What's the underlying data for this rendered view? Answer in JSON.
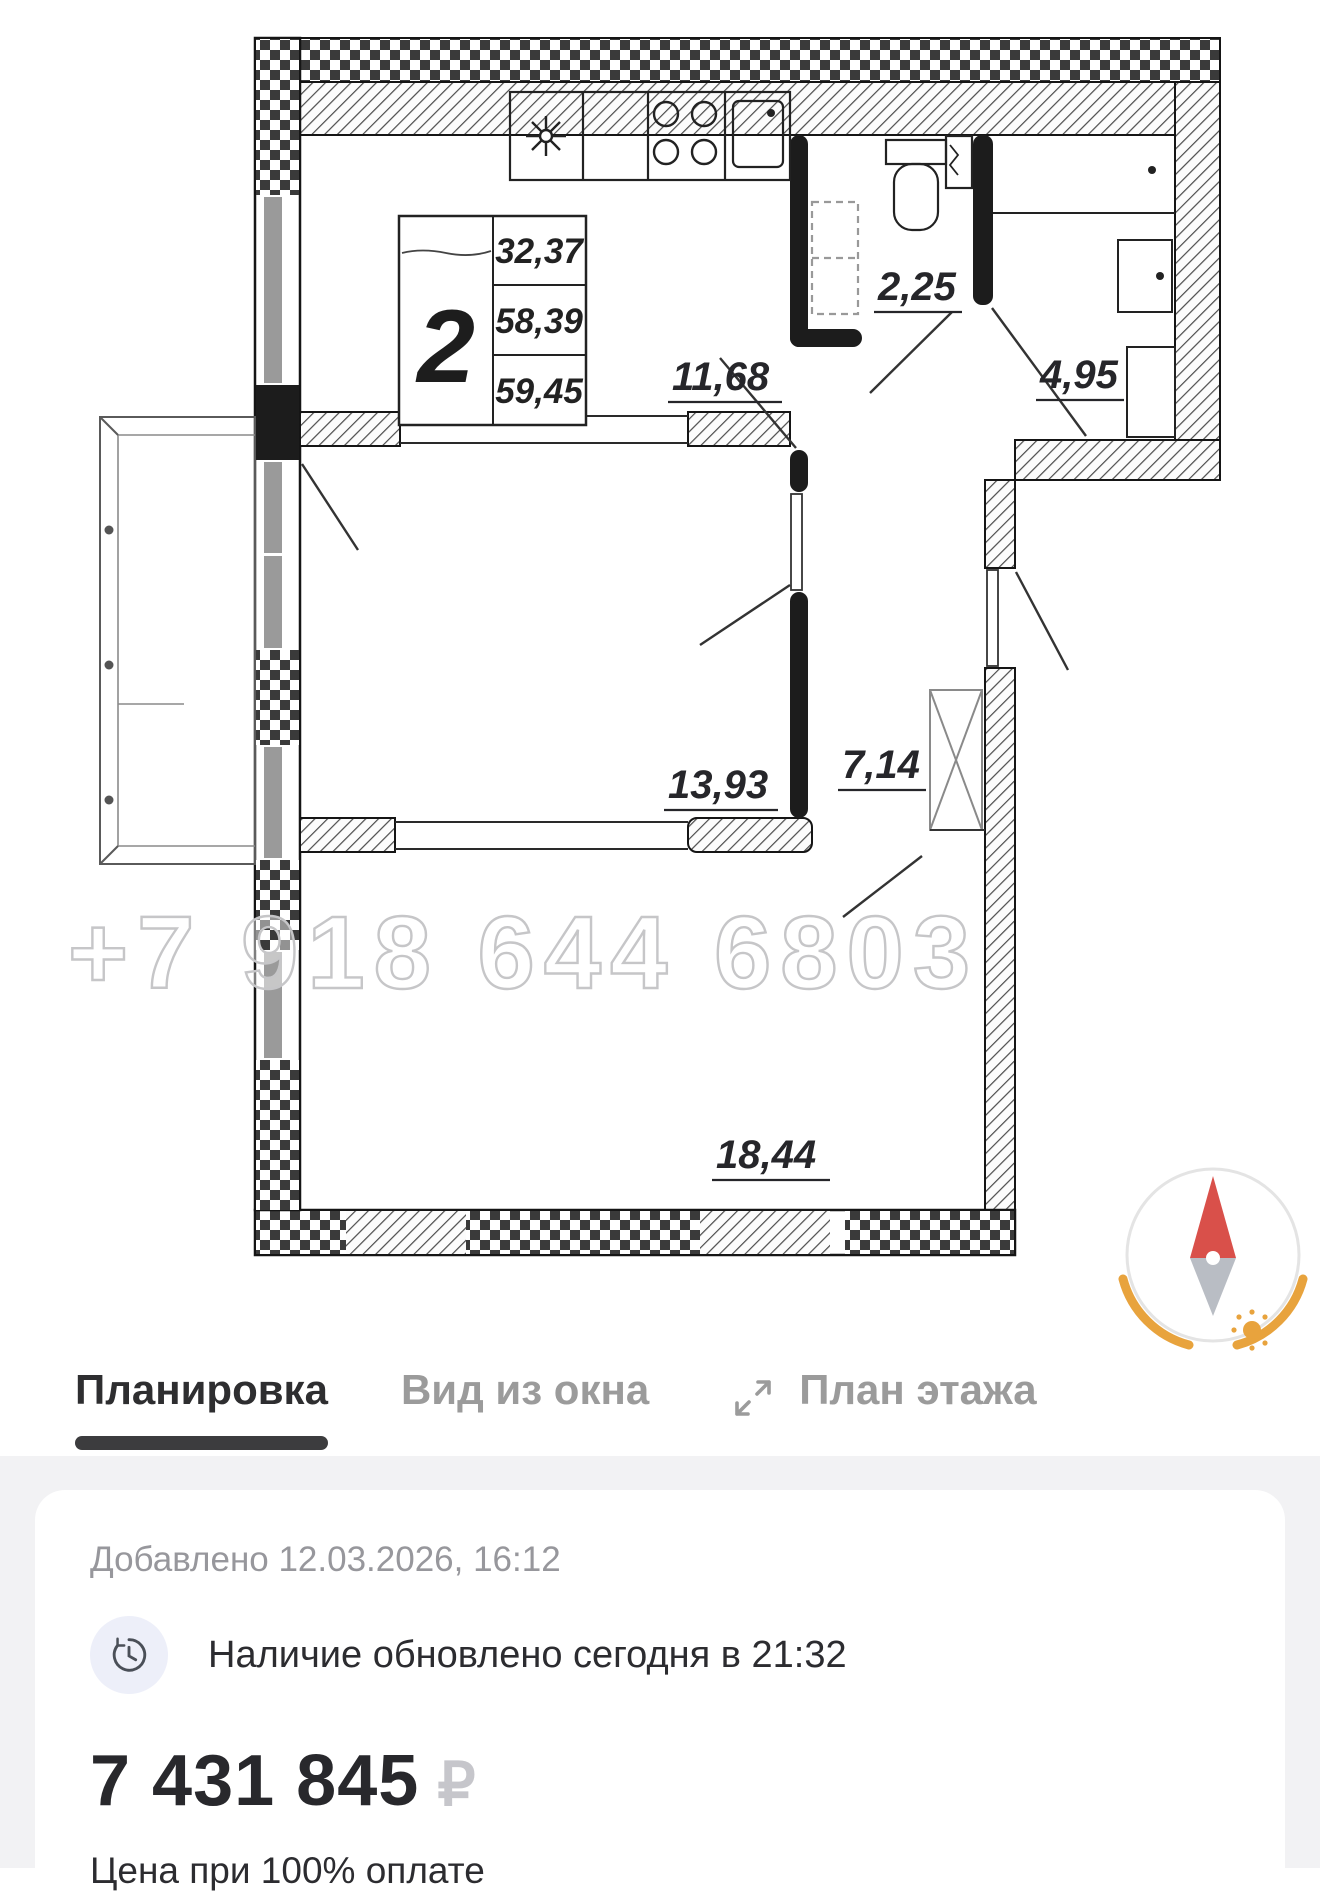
{
  "plan": {
    "watermark": "+7 918 644 6803",
    "unit_table": {
      "rooms": "2",
      "area_living": "32,37",
      "area_total": "58,39",
      "area_with_balcony": "59,45"
    },
    "labels": {
      "kitchen": "11,68",
      "wc": "2,25",
      "bathroom": "4,95",
      "bedroom": "13,93",
      "hall": "7,14",
      "living": "18,44"
    }
  },
  "tabs": {
    "layout": "Планировка",
    "window_view": "Вид из окна",
    "floor_plan": "План этажа"
  },
  "info": {
    "added": "Добавлено 12.03.2026, 16:12",
    "availability": "Наличие обновлено сегодня в 21:32",
    "price": "7 431 845",
    "currency": "₽",
    "price_note": "Цена при 100% оплате"
  },
  "colors": {
    "accent_dark": "#2e2e30",
    "tab_inactive": "#9b9b9b",
    "section_bg": "#f2f2f4",
    "muted": "#97979c",
    "currency_gray": "#c6c6cb",
    "compass_red": "#d9504a",
    "compass_orange": "#e8a33d"
  }
}
